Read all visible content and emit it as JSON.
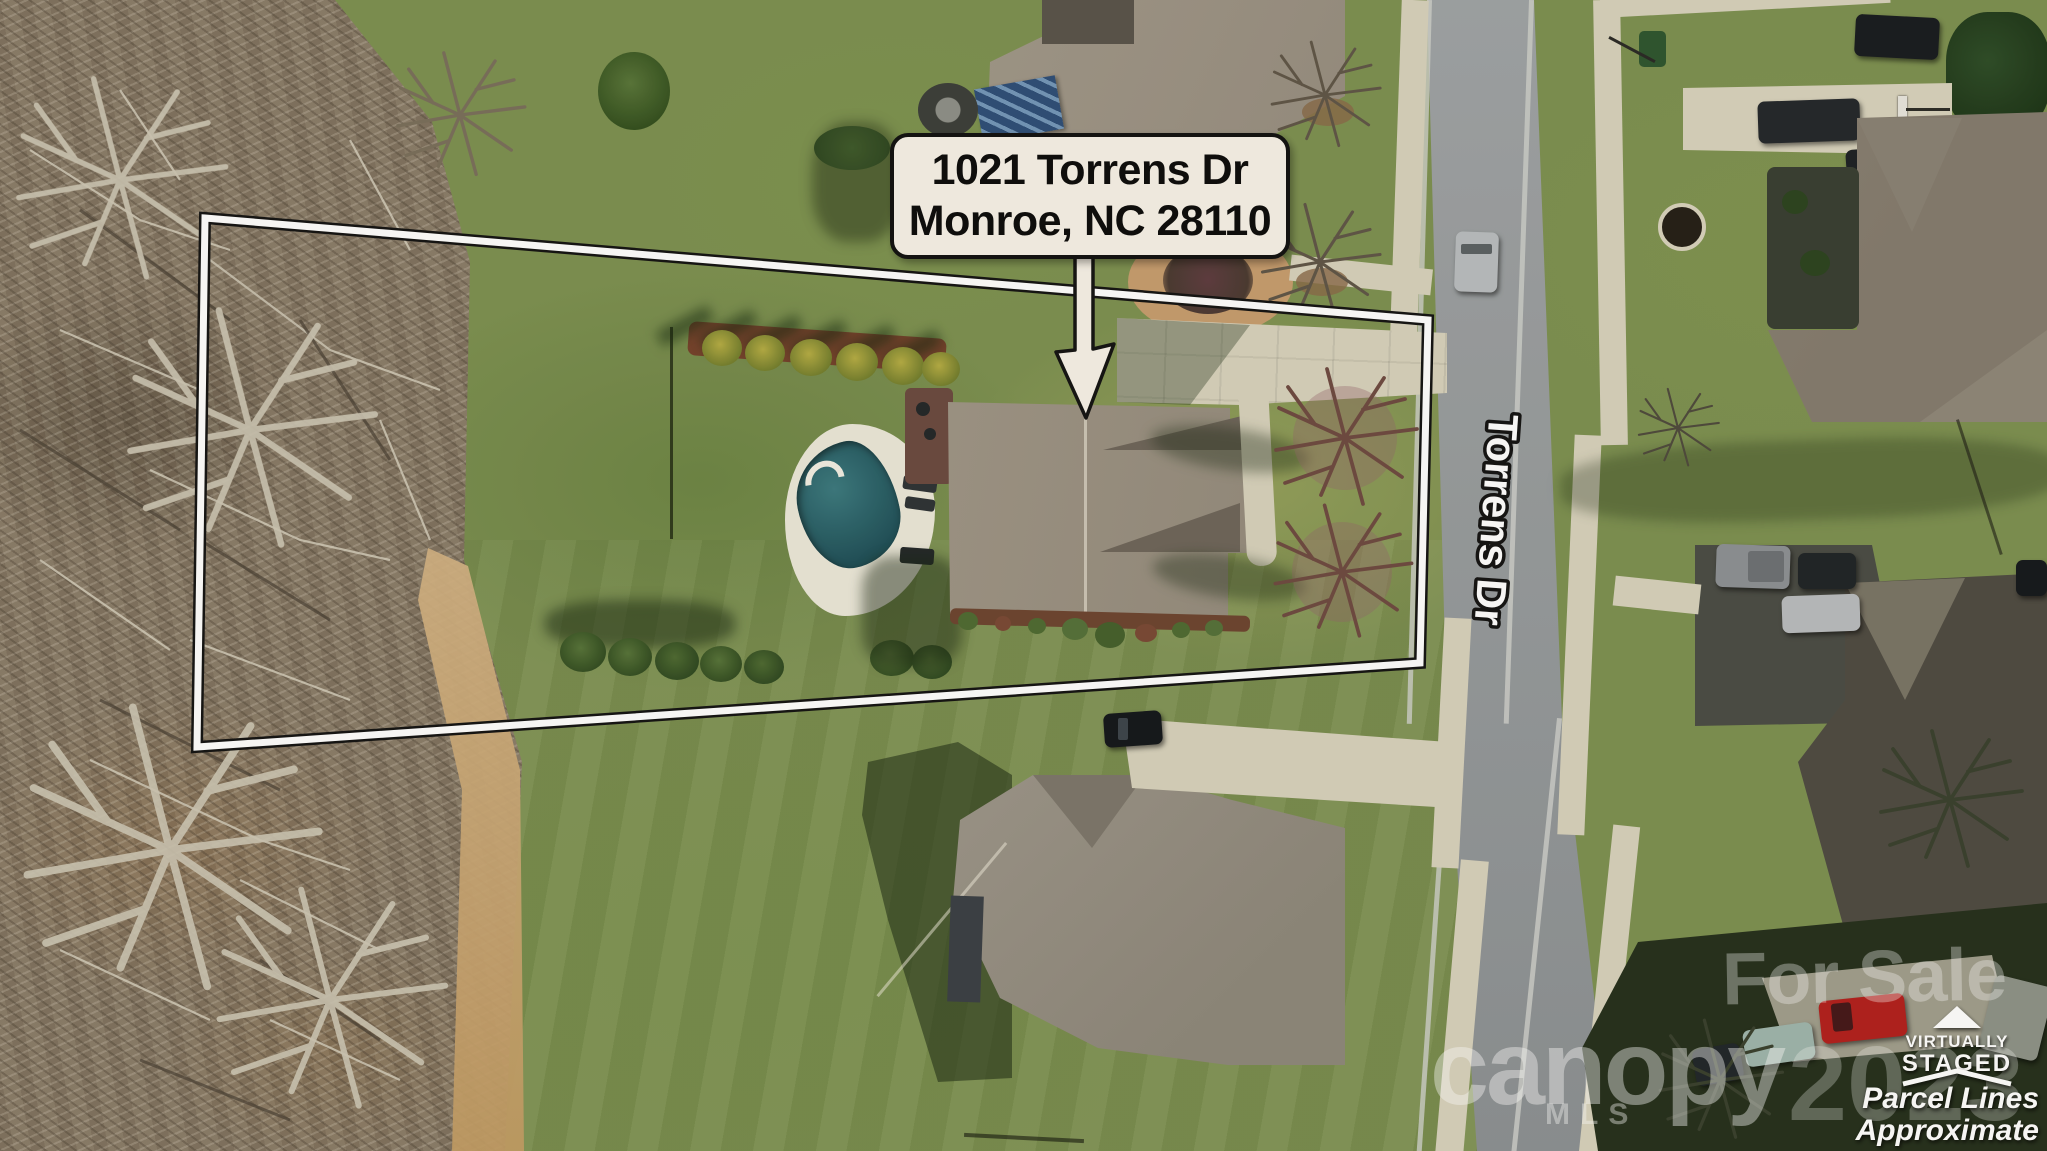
{
  "address_label": {
    "line1": "1021 Torrens Dr",
    "line2": "Monroe, NC 28110"
  },
  "street_label": "Torrens Dr",
  "watermarks": {
    "for_sale": "For Sale",
    "brand": "canopy",
    "brand_sub": "MLS",
    "year": "2023",
    "badge_line1": "VIRTUALLY",
    "badge_line2": "STAGED",
    "disclaimer_line1": "Parcel Lines",
    "disclaimer_line2": "Approximate"
  },
  "colors": {
    "label_bg": "#f7f2e8",
    "label_border": "#111111",
    "parcel_line_white": "#ffffff",
    "parcel_line_black": "#141414",
    "pool_water": "#2c6b72",
    "pool_deck": "#ebe8da",
    "road": "#979c9f",
    "grass": "#7d9152",
    "woods": "#8a7e6c",
    "concrete": "#d7d2bd",
    "red_truck": "#b3201e"
  }
}
